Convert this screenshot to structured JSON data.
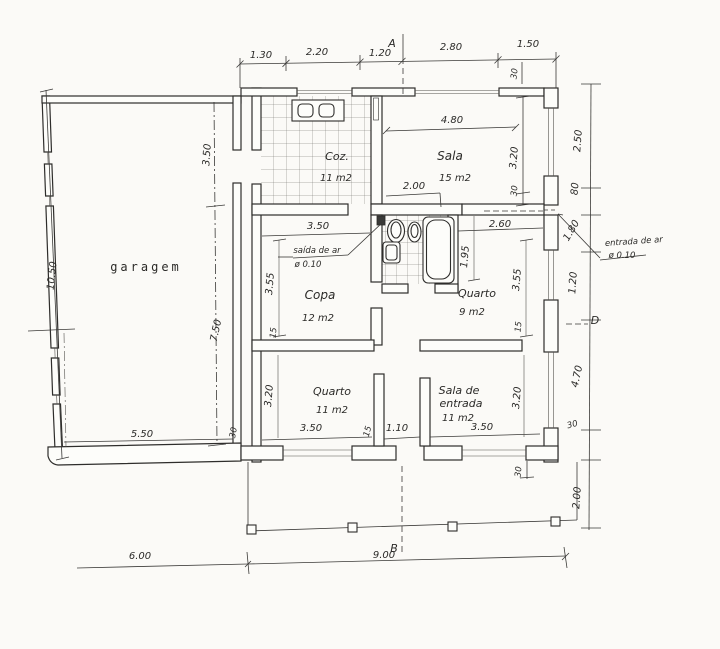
{
  "sections": {
    "a": "A",
    "b": "B",
    "d": "D"
  },
  "rooms": {
    "garage": {
      "label": "garagem"
    },
    "kitchen": {
      "label": "Coz.",
      "area": "11 m2"
    },
    "living": {
      "label": "Sala",
      "area": "15 m2"
    },
    "dining": {
      "label": "Copa",
      "area": "12 m2"
    },
    "bedroom9": {
      "label": "Quarto",
      "area": "9 m2"
    },
    "bedroom11": {
      "label": "Quarto",
      "area": "11 m2"
    },
    "entry": {
      "label_line1": "Sala de",
      "label_line2": "entrada",
      "area": "11 m2"
    }
  },
  "annotations": {
    "air_outlet": {
      "label": "saída de ar",
      "diameter": "ø 0.10"
    },
    "air_inlet": {
      "label": "entrada de ar",
      "diameter": "ø 0.10"
    }
  },
  "dims": {
    "top": [
      "1.30",
      "2.20",
      "1.20",
      "2.80",
      "1.50"
    ],
    "top_wall": "30",
    "right": [
      "2.50",
      "80",
      "1.80",
      "1.20",
      "4.70",
      "30",
      "2.00"
    ],
    "left_height": "10.50",
    "garage": {
      "depth_upper": "3.50",
      "depth_lower": "7.50",
      "width": "5.50",
      "wall": "30"
    },
    "living": {
      "width": "4.80",
      "opening": "2.00",
      "depth": "3.20",
      "wall": "30"
    },
    "dining": {
      "width": "3.50",
      "depth": "3.55",
      "wall": "15"
    },
    "bath": {
      "depth": "1.95"
    },
    "bedroom9": {
      "width": "2.60",
      "depth": "3.55",
      "wall": "15"
    },
    "bedroom11": {
      "width": "3.50",
      "depth": "3.20",
      "wall": "15"
    },
    "hall": {
      "width": "1.10"
    },
    "entry": {
      "width": "3.50",
      "depth": "3.20"
    },
    "bottom": {
      "wall": "30",
      "garage_span": "6.00",
      "house_span": "9.00"
    }
  }
}
